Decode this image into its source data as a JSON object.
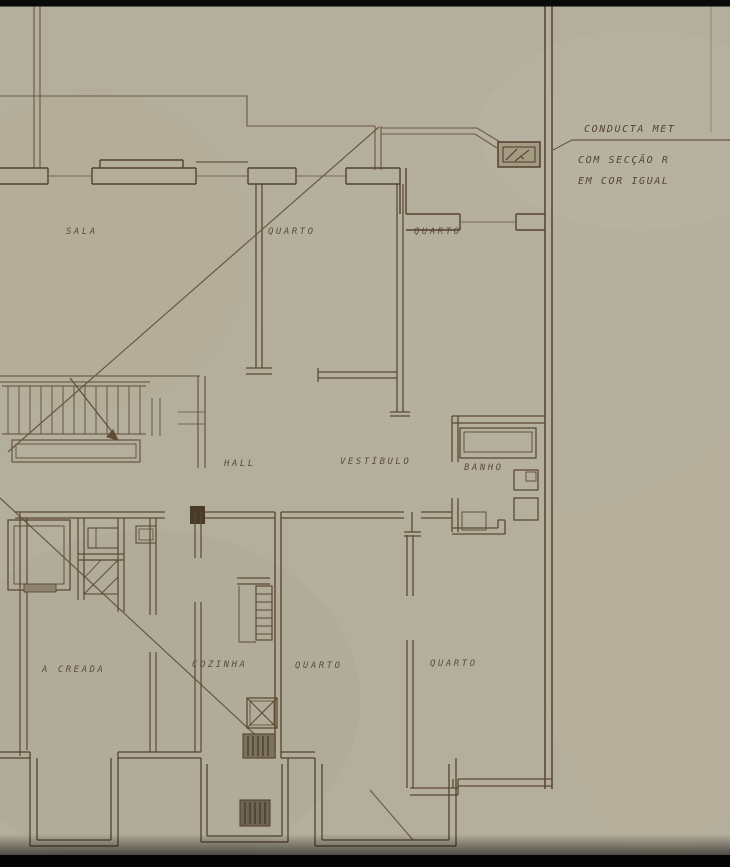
{
  "meta": {
    "title": "Sepia architectural floor plan — apartment storey (scanned drawing)"
  },
  "colors": {
    "paper": "#b4ae9c",
    "ink": "#5c4a33",
    "ink_dark": "#3f3226",
    "label_ink": "#4f3f2c",
    "scan_edge_black": "#0a0a0a"
  },
  "annotation": {
    "line1": "CONDUCTA MET",
    "line2": "COM SECÇÃO R",
    "line3": "EM COR IGUAL"
  },
  "rooms": {
    "sala": "SALA",
    "quarto_top_left": "QUARTO",
    "quarto_top_right": "QUARTO",
    "hall": "HALL",
    "vestibulo": "VESTÍBULO",
    "banho": "BANHO",
    "creada": "A CREADA",
    "cozinha": "COZINHA",
    "quarto_bottom_left": "QUARTO",
    "quarto_bottom_right": "QUARTO"
  }
}
